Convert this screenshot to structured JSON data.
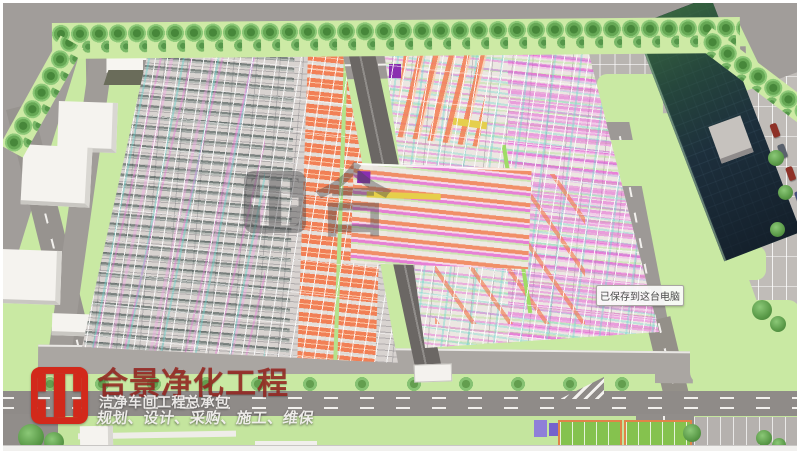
{
  "brand": {
    "name": "合景净化工程",
    "subtitle": "洁净车间工程总承包",
    "tagline": "规划、设计、采购、施工、维保"
  },
  "notification": {
    "saved_text": "已保存到这台电脑"
  },
  "watermark": {
    "glyph": "合"
  },
  "palette": {
    "brand_red": "#d2291b",
    "title_red": "#96241e",
    "ground_gray": "#a19d9a",
    "road_gray": "#8f8b88",
    "lawn_green": "#c9e9a3",
    "duct_orange": "#f37c50",
    "pipe_magenta": "#e65cd6",
    "pipe_cyan": "#7dd7cc",
    "pipe_green": "#aade82",
    "equipment_teal": "#3c5a54",
    "tower_glass": "#1d2f3c",
    "tower_green": "#3a6a40"
  }
}
